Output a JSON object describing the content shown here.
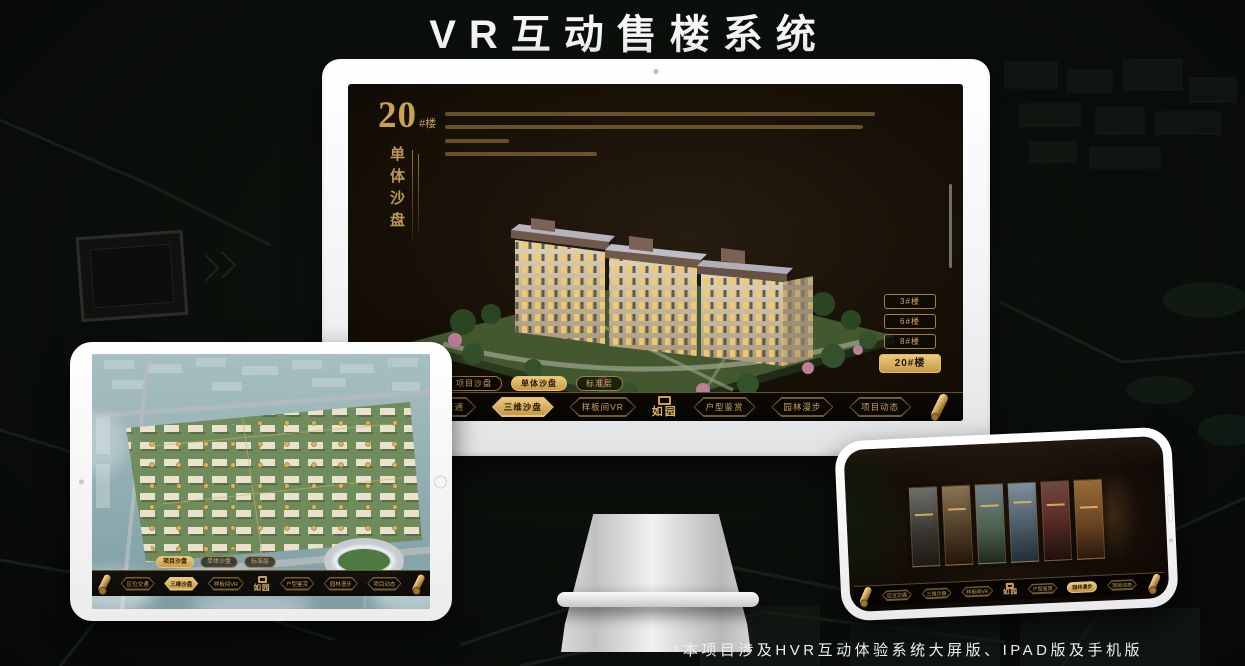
{
  "title": "VR互动售楼系统",
  "footnote": "*本项目涉及HVR互动体验系统大屏版、IPAD版及手机版",
  "brand": {
    "logo_text": "如园",
    "gold": "#c9a055",
    "gold_active_bg": "#d9b05f",
    "screen_bg": "#17110a"
  },
  "nav": {
    "items": [
      "区位交通",
      "三维沙盘",
      "样板间VR",
      "户型鉴赏",
      "园林漫步",
      "项目动态"
    ],
    "tabs": [
      "项目沙盘",
      "单体沙盘",
      "标准层"
    ]
  },
  "monitor": {
    "heading": {
      "number": "20",
      "unit": "#楼",
      "subtitle": "单体沙盘"
    },
    "floor_buttons": [
      "3#楼",
      "6#楼",
      "8#楼",
      "20#楼"
    ],
    "active_floor": "20#楼",
    "active_tab": "单体沙盘",
    "active_nav": "三维沙盘"
  },
  "tablet": {
    "active_tab": "项目沙盘",
    "active_nav": "三维沙盘"
  },
  "phone": {
    "active_nav": "园林漫步",
    "scene_count": "6"
  }
}
